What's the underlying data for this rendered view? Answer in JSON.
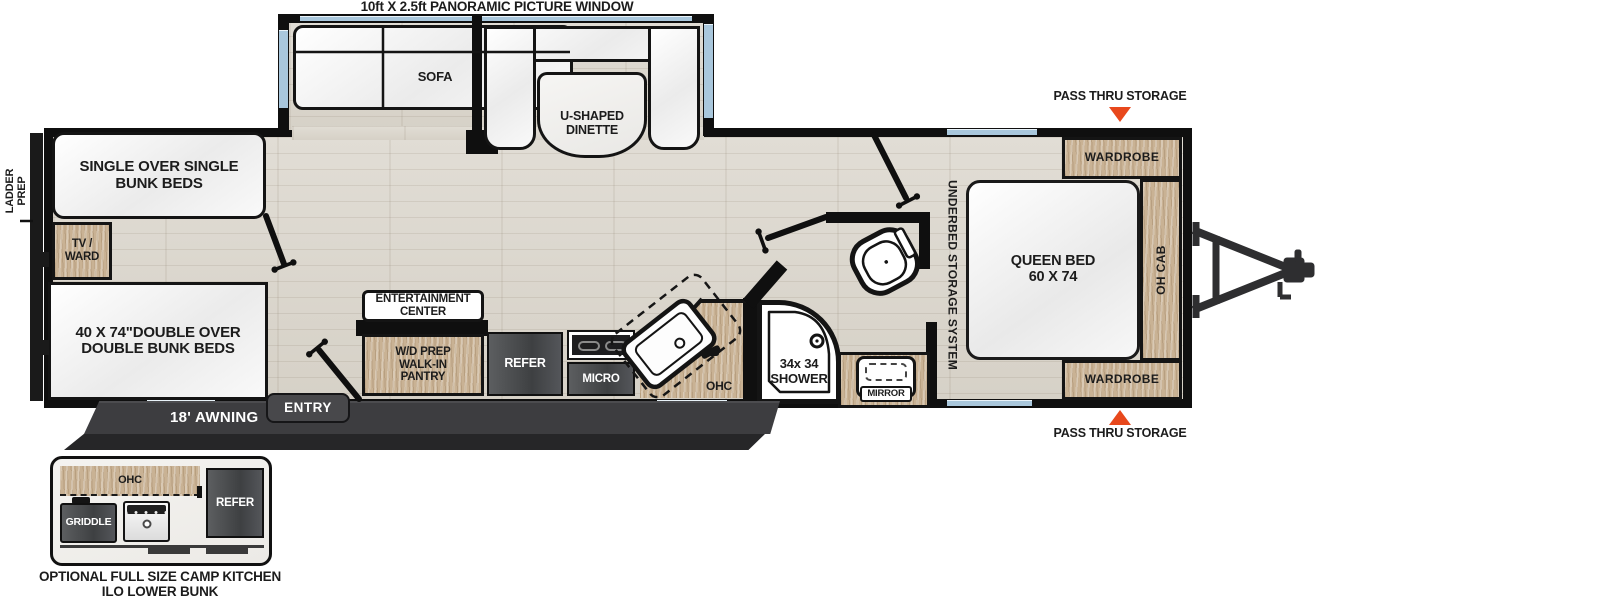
{
  "title": "10ft X 2.5ft PANORAMIC PICTURE WINDOW",
  "labels": {
    "ladder_prep": "LADDER\nPREP",
    "sofa": "SOFA",
    "dinette": "U-SHAPED\nDINETTE",
    "single_bunk": "SINGLE OVER SINGLE\nBUNK BEDS",
    "tv_ward": "TV /\nWARD",
    "double_bunk": "40 X 74\"DOUBLE OVER\nDOUBLE BUNK BEDS",
    "entertainment": "ENTERTAINMENT\nCENTER",
    "pantry": "W/D PREP\nWALK-IN\nPANTRY",
    "refer": "REFER",
    "micro": "MICRO",
    "ohc": "OHC",
    "shower": "34x 34\nSHOWER",
    "mirror": "MIRROR",
    "underbed": "UNDERBED STORAGE SYSTEM",
    "queen_bed": "QUEEN BED\n60 X 74",
    "wardrobe": "WARDROBE",
    "oh_cab": "OH CAB",
    "pass_thru": "PASS THRU STORAGE",
    "awning": "18' AWNING",
    "entry": "ENTRY",
    "griddle": "GRIDDLE",
    "inset_caption": "OPTIONAL FULL SIZE CAMP KITCHEN\nILO LOWER BUNK"
  },
  "colors": {
    "wall": "#0F0F0F",
    "floor": "#DCD7CE",
    "wood": "#C9B294",
    "appliance_dark": "#4A4C4E",
    "window_blue": "#A9C7DC",
    "awning_gray": "#3D3D40",
    "accent_orange": "#E8481C"
  }
}
